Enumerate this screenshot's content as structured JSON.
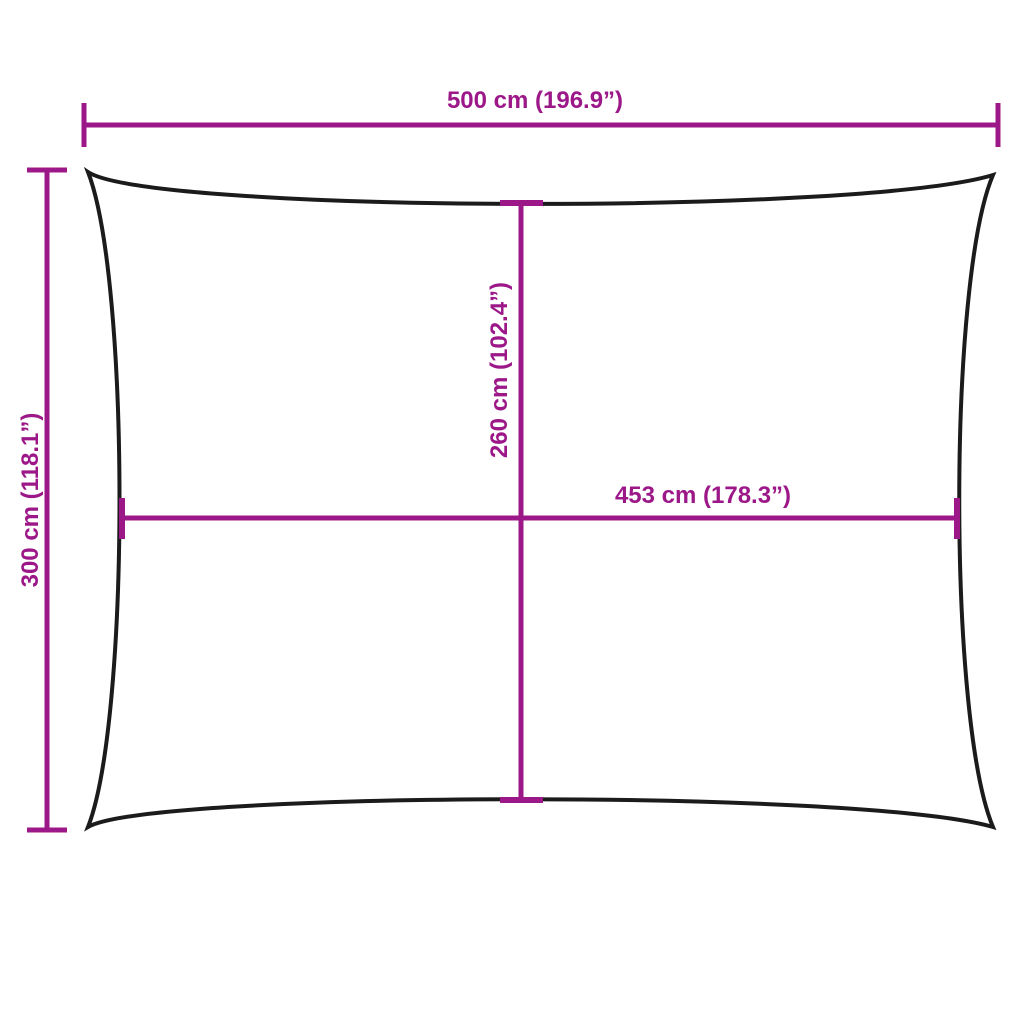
{
  "colors": {
    "dimension": "#9C1888",
    "outline": "#1B1B1B",
    "background": "#FFFFFF"
  },
  "dimensions": {
    "overall_width": {
      "label": "500 cm (196.9”)"
    },
    "overall_height": {
      "label": "300 cm (118.1”)"
    },
    "inner_height": {
      "label": "260 cm (102.4”)"
    },
    "inner_width": {
      "label": "453 cm (178.3”)"
    }
  }
}
